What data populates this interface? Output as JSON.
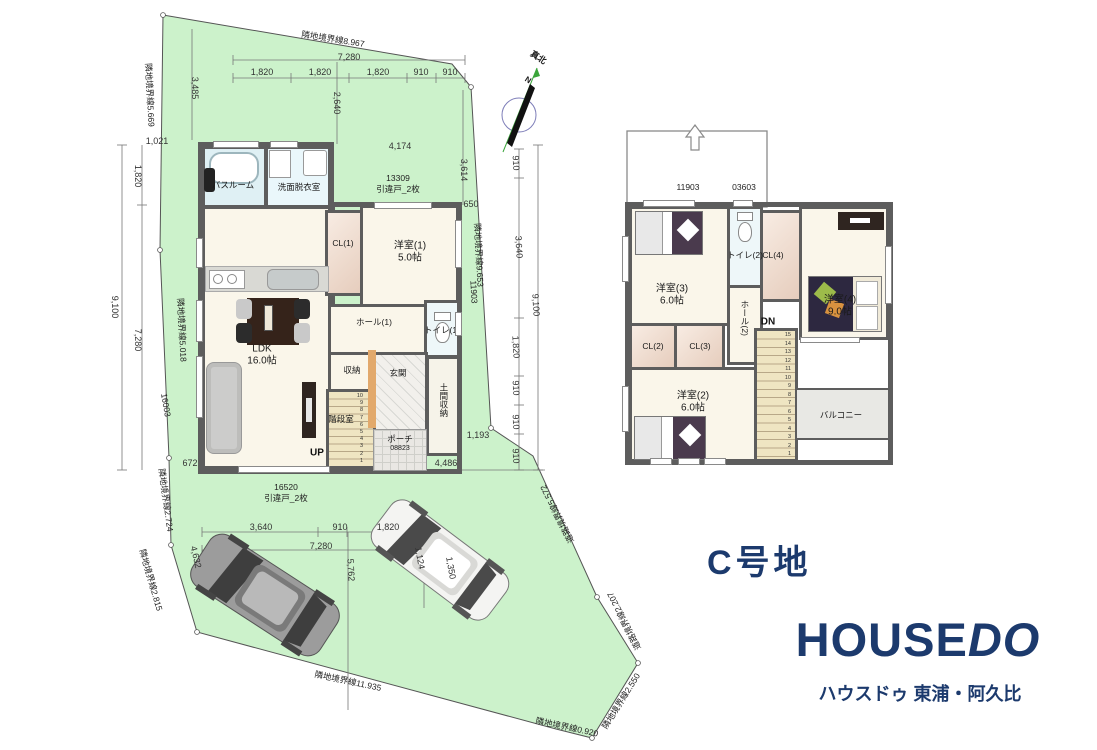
{
  "site": {
    "title": "C号地"
  },
  "branding": {
    "logo_part1": "HOUSE",
    "logo_part2": "DO",
    "subtitle": "ハウスドゥ 東浦・阿久比",
    "navy": "#1c3a6d"
  },
  "compass": {
    "true_north": "真北",
    "n": "N"
  },
  "floor1": {
    "bathroom": "バスルーム",
    "washroom": "洗面脱衣室",
    "cl1": "CL(1)",
    "bed1": "洋室(1)",
    "bed1_size": "5.0帖",
    "ldk": "LDK",
    "ldk_size": "16.0帖",
    "hall1": "ホール(1)",
    "toilet1": "トイレ(1)",
    "storage": "収納",
    "genkan": "玄関",
    "stair_room": "階段室",
    "up": "UP",
    "doma": "土間収納",
    "porch": "ポーチ",
    "porch_code": "08823",
    "stair_numbers": [
      1,
      2,
      3,
      4,
      5,
      6,
      7,
      8,
      9,
      10
    ]
  },
  "floor2": {
    "bed3": "洋室(3)",
    "bed3_size": "6.0帖",
    "toilet2": "トイレ(2)",
    "cl4": "CL(4)",
    "bed4": "洋室(4)",
    "bed4_size": "9.0帖",
    "cl2": "CL(2)",
    "cl3": "CL(3)",
    "hall2": "ホール(2)",
    "dn": "DN",
    "bed2": "洋室(2)",
    "bed2_size": "6.0帖",
    "balcony": "バルコニー",
    "stair_numbers": [
      1,
      2,
      3,
      4,
      5,
      6,
      7,
      8,
      9,
      10,
      11,
      12,
      13,
      14,
      15
    ]
  },
  "annotations": {
    "dimensions": [
      {
        "text": "7,280",
        "x": 349,
        "y": 57,
        "rot": 0
      },
      {
        "text": "1,820",
        "x": 262,
        "y": 72,
        "rot": 0
      },
      {
        "text": "1,820",
        "x": 320,
        "y": 72,
        "rot": 0
      },
      {
        "text": "1,820",
        "x": 378,
        "y": 72,
        "rot": 0
      },
      {
        "text": "910",
        "x": 421,
        "y": 72,
        "rot": 0
      },
      {
        "text": "910",
        "x": 450,
        "y": 72,
        "rot": 0
      },
      {
        "text": "3,485",
        "x": 195,
        "y": 88,
        "rot": 90
      },
      {
        "text": "2,640",
        "x": 337,
        "y": 103,
        "rot": 90
      },
      {
        "text": "1,021",
        "x": 157,
        "y": 141,
        "rot": 0
      },
      {
        "text": "4,174",
        "x": 400,
        "y": 146,
        "rot": 0
      },
      {
        "text": "3,614",
        "x": 464,
        "y": 170,
        "rot": 90
      },
      {
        "text": "650",
        "x": 471,
        "y": 204,
        "rot": 0
      },
      {
        "text": "9,100",
        "x": 115,
        "y": 307,
        "rot": 90
      },
      {
        "text": "1,820",
        "x": 138,
        "y": 176,
        "rot": 90
      },
      {
        "text": "7,280",
        "x": 138,
        "y": 340,
        "rot": 90
      },
      {
        "text": "672",
        "x": 190,
        "y": 463,
        "rot": 0
      },
      {
        "text": "910",
        "x": 516,
        "y": 163,
        "rot": 87
      },
      {
        "text": "3,640",
        "x": 519,
        "y": 247,
        "rot": 87
      },
      {
        "text": "9,100",
        "x": 536,
        "y": 305,
        "rot": 87
      },
      {
        "text": "1,820",
        "x": 516,
        "y": 347,
        "rot": 87
      },
      {
        "text": "910",
        "x": 516,
        "y": 388,
        "rot": 87
      },
      {
        "text": "910",
        "x": 516,
        "y": 422,
        "rot": 87
      },
      {
        "text": "910",
        "x": 516,
        "y": 456,
        "rot": 87
      },
      {
        "text": "1,193",
        "x": 478,
        "y": 435,
        "rot": 0
      },
      {
        "text": "4,486",
        "x": 446,
        "y": 463,
        "rot": 0
      },
      {
        "text": "3,640",
        "x": 261,
        "y": 527,
        "rot": 0
      },
      {
        "text": "910",
        "x": 340,
        "y": 527,
        "rot": 0
      },
      {
        "text": "1,820",
        "x": 388,
        "y": 527,
        "rot": 0
      },
      {
        "text": "7,280",
        "x": 321,
        "y": 546,
        "rot": 0
      },
      {
        "text": "4,632",
        "x": 196,
        "y": 557,
        "rot": 77
      },
      {
        "text": "5,762",
        "x": 351,
        "y": 570,
        "rot": 87
      },
      {
        "text": "1,124",
        "x": 420,
        "y": 558,
        "rot": 80
      },
      {
        "text": "1,350",
        "x": 451,
        "y": 568,
        "rot": 80
      }
    ],
    "window_codes": [
      {
        "text": "13309",
        "x": 398,
        "y": 178,
        "rot": 0
      },
      {
        "text": "引違戸_2枚",
        "x": 398,
        "y": 189,
        "rot": 0
      },
      {
        "text": "16520",
        "x": 286,
        "y": 487,
        "rot": 0
      },
      {
        "text": "引違戸_2枚",
        "x": 286,
        "y": 498,
        "rot": 0
      },
      {
        "text": "16003",
        "x": 166,
        "y": 405,
        "rot": 80
      },
      {
        "text": "11903",
        "x": 474,
        "y": 292,
        "rot": 87
      },
      {
        "text": "11903",
        "x": 688,
        "y": 187,
        "rot": 0
      },
      {
        "text": "03603",
        "x": 744,
        "y": 187,
        "rot": 0
      }
    ],
    "boundaries": [
      {
        "text": "隣地境界線8.967",
        "x": 333,
        "y": 39,
        "rot": 9
      },
      {
        "text": "隣地境界線5.669",
        "x": 150,
        "y": 95,
        "rot": 87
      },
      {
        "text": "隣地境界線5.018",
        "x": 182,
        "y": 330,
        "rot": 87
      },
      {
        "text": "隣地境界線2.724",
        "x": 166,
        "y": 500,
        "rot": 82
      },
      {
        "text": "隣地境界線2.815",
        "x": 151,
        "y": 580,
        "rot": 74
      },
      {
        "text": "隣地境界線11.935",
        "x": 348,
        "y": 681,
        "rot": 12
      },
      {
        "text": "隣地境界線0.920",
        "x": 567,
        "y": 727,
        "rot": 12
      },
      {
        "text": "隣地境界線2.550",
        "x": 621,
        "y": 701,
        "rot": -58
      },
      {
        "text": "隣地境界線9.653",
        "x": 479,
        "y": 255,
        "rot": 87
      },
      {
        "text": "道路境界線5.572",
        "x": 557,
        "y": 514,
        "rot": 243
      },
      {
        "text": "道路境界線2.207",
        "x": 624,
        "y": 621,
        "rot": 243
      }
    ]
  },
  "colors": {
    "site_green": "#ccf2cb",
    "wall": "#5d5d5d",
    "navy": "#1c3a6d",
    "stair_tan": "#efe5c2"
  }
}
